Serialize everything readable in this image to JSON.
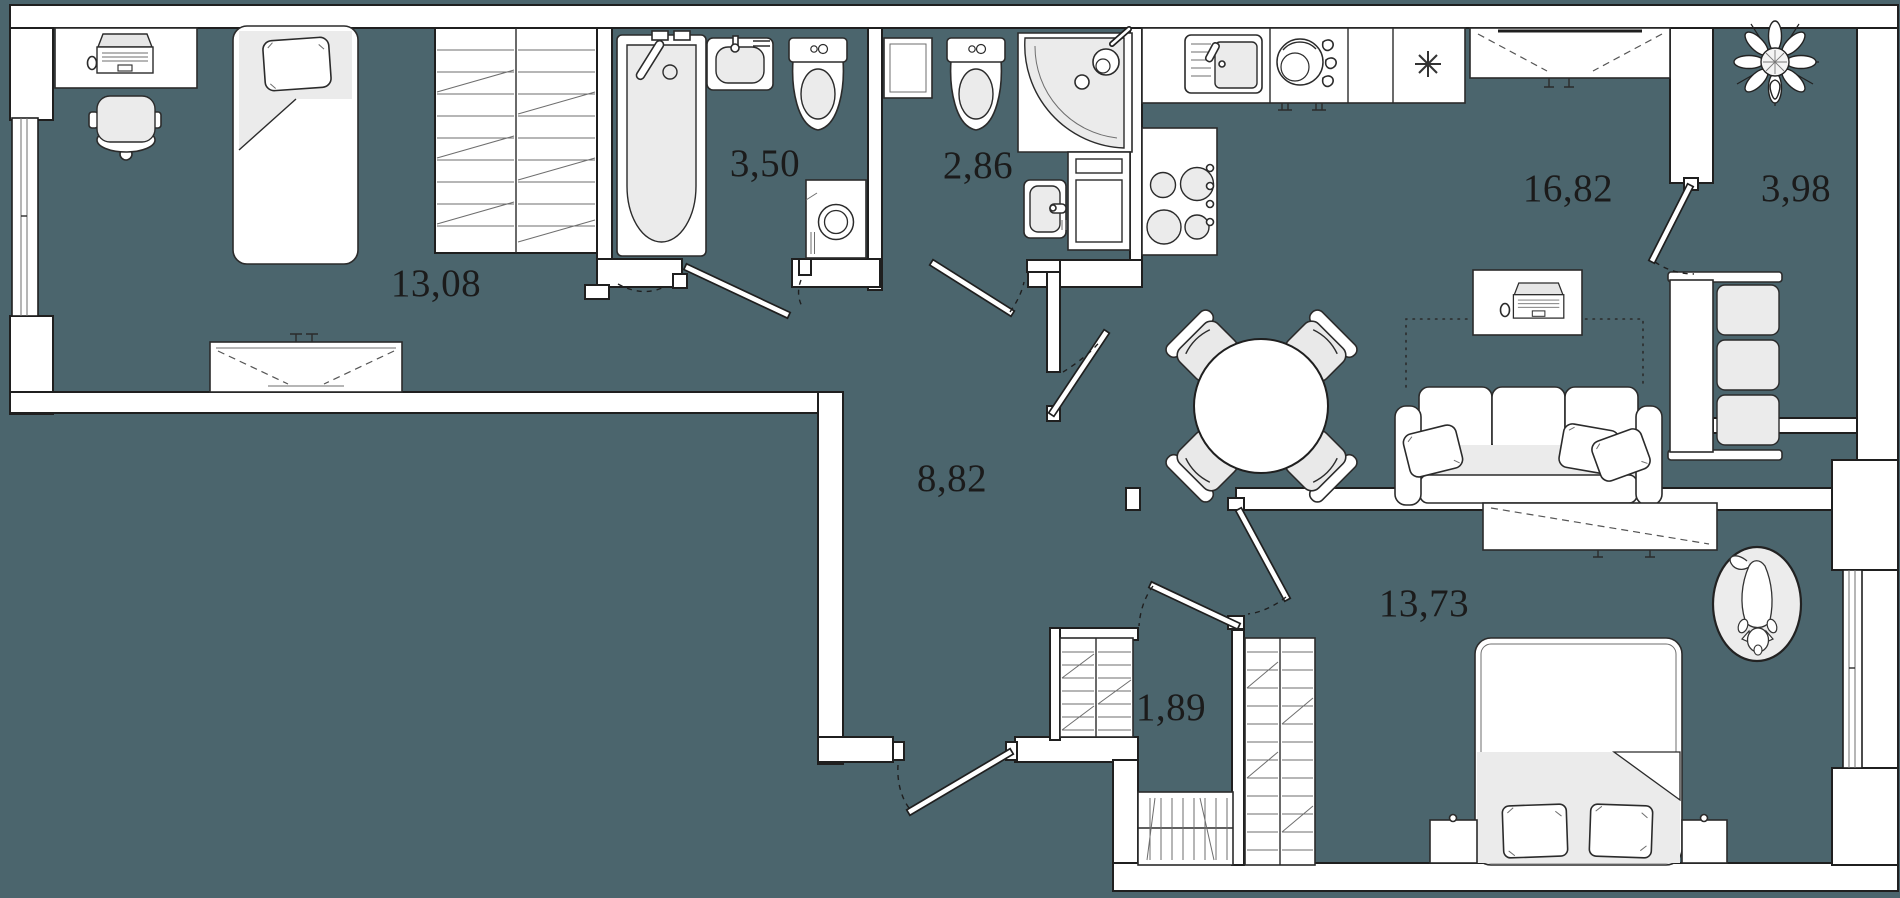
{
  "plan": {
    "type": "apartment-floor-plan",
    "background_color": "#4B656D",
    "wall_fill": "#FFFFFF",
    "line_color": "#1F1F1F",
    "fixture_shade": "#EBEBEB",
    "area_unit": "m2"
  },
  "rooms": [
    {
      "id": "bedroom-left",
      "area": "13,08"
    },
    {
      "id": "bathroom",
      "area": "3,50"
    },
    {
      "id": "wc-shower",
      "area": "2,86"
    },
    {
      "id": "hallway",
      "area": "8,82"
    },
    {
      "id": "living-kitchen",
      "area": "16,82"
    },
    {
      "id": "balcony",
      "area": "3,98"
    },
    {
      "id": "bedroom-right",
      "area": "13,73"
    },
    {
      "id": "closet",
      "area": "1,89"
    }
  ],
  "furniture": [
    "desk-with-laptop-left",
    "office-chair",
    "single-bed",
    "dresser",
    "built-in-wardrobe",
    "bathtub",
    "washbasin",
    "toilet",
    "washing-machine",
    "storage-cabinet",
    "toilet-2",
    "corner-shower",
    "small-washbasin",
    "tall-cabinet",
    "kitchen-counter",
    "kitchen-sink",
    "dishwasher",
    "refrigerator-snowflake",
    "cooktop",
    "wall-cabinet-dashed",
    "round-dining-table",
    "dining-chairs",
    "sofa-three-seat",
    "sofa-pillows",
    "desk-with-laptop-right",
    "tv-stand",
    "balcony-bench",
    "potted-plant",
    "double-bed",
    "nightstand-left",
    "nightstand-right",
    "wardrobe-rail",
    "wardrobe-shelves",
    "wardrobe-vertical",
    "dog-on-oval-rug",
    "entrance-door",
    "interior-doors",
    "windows"
  ]
}
